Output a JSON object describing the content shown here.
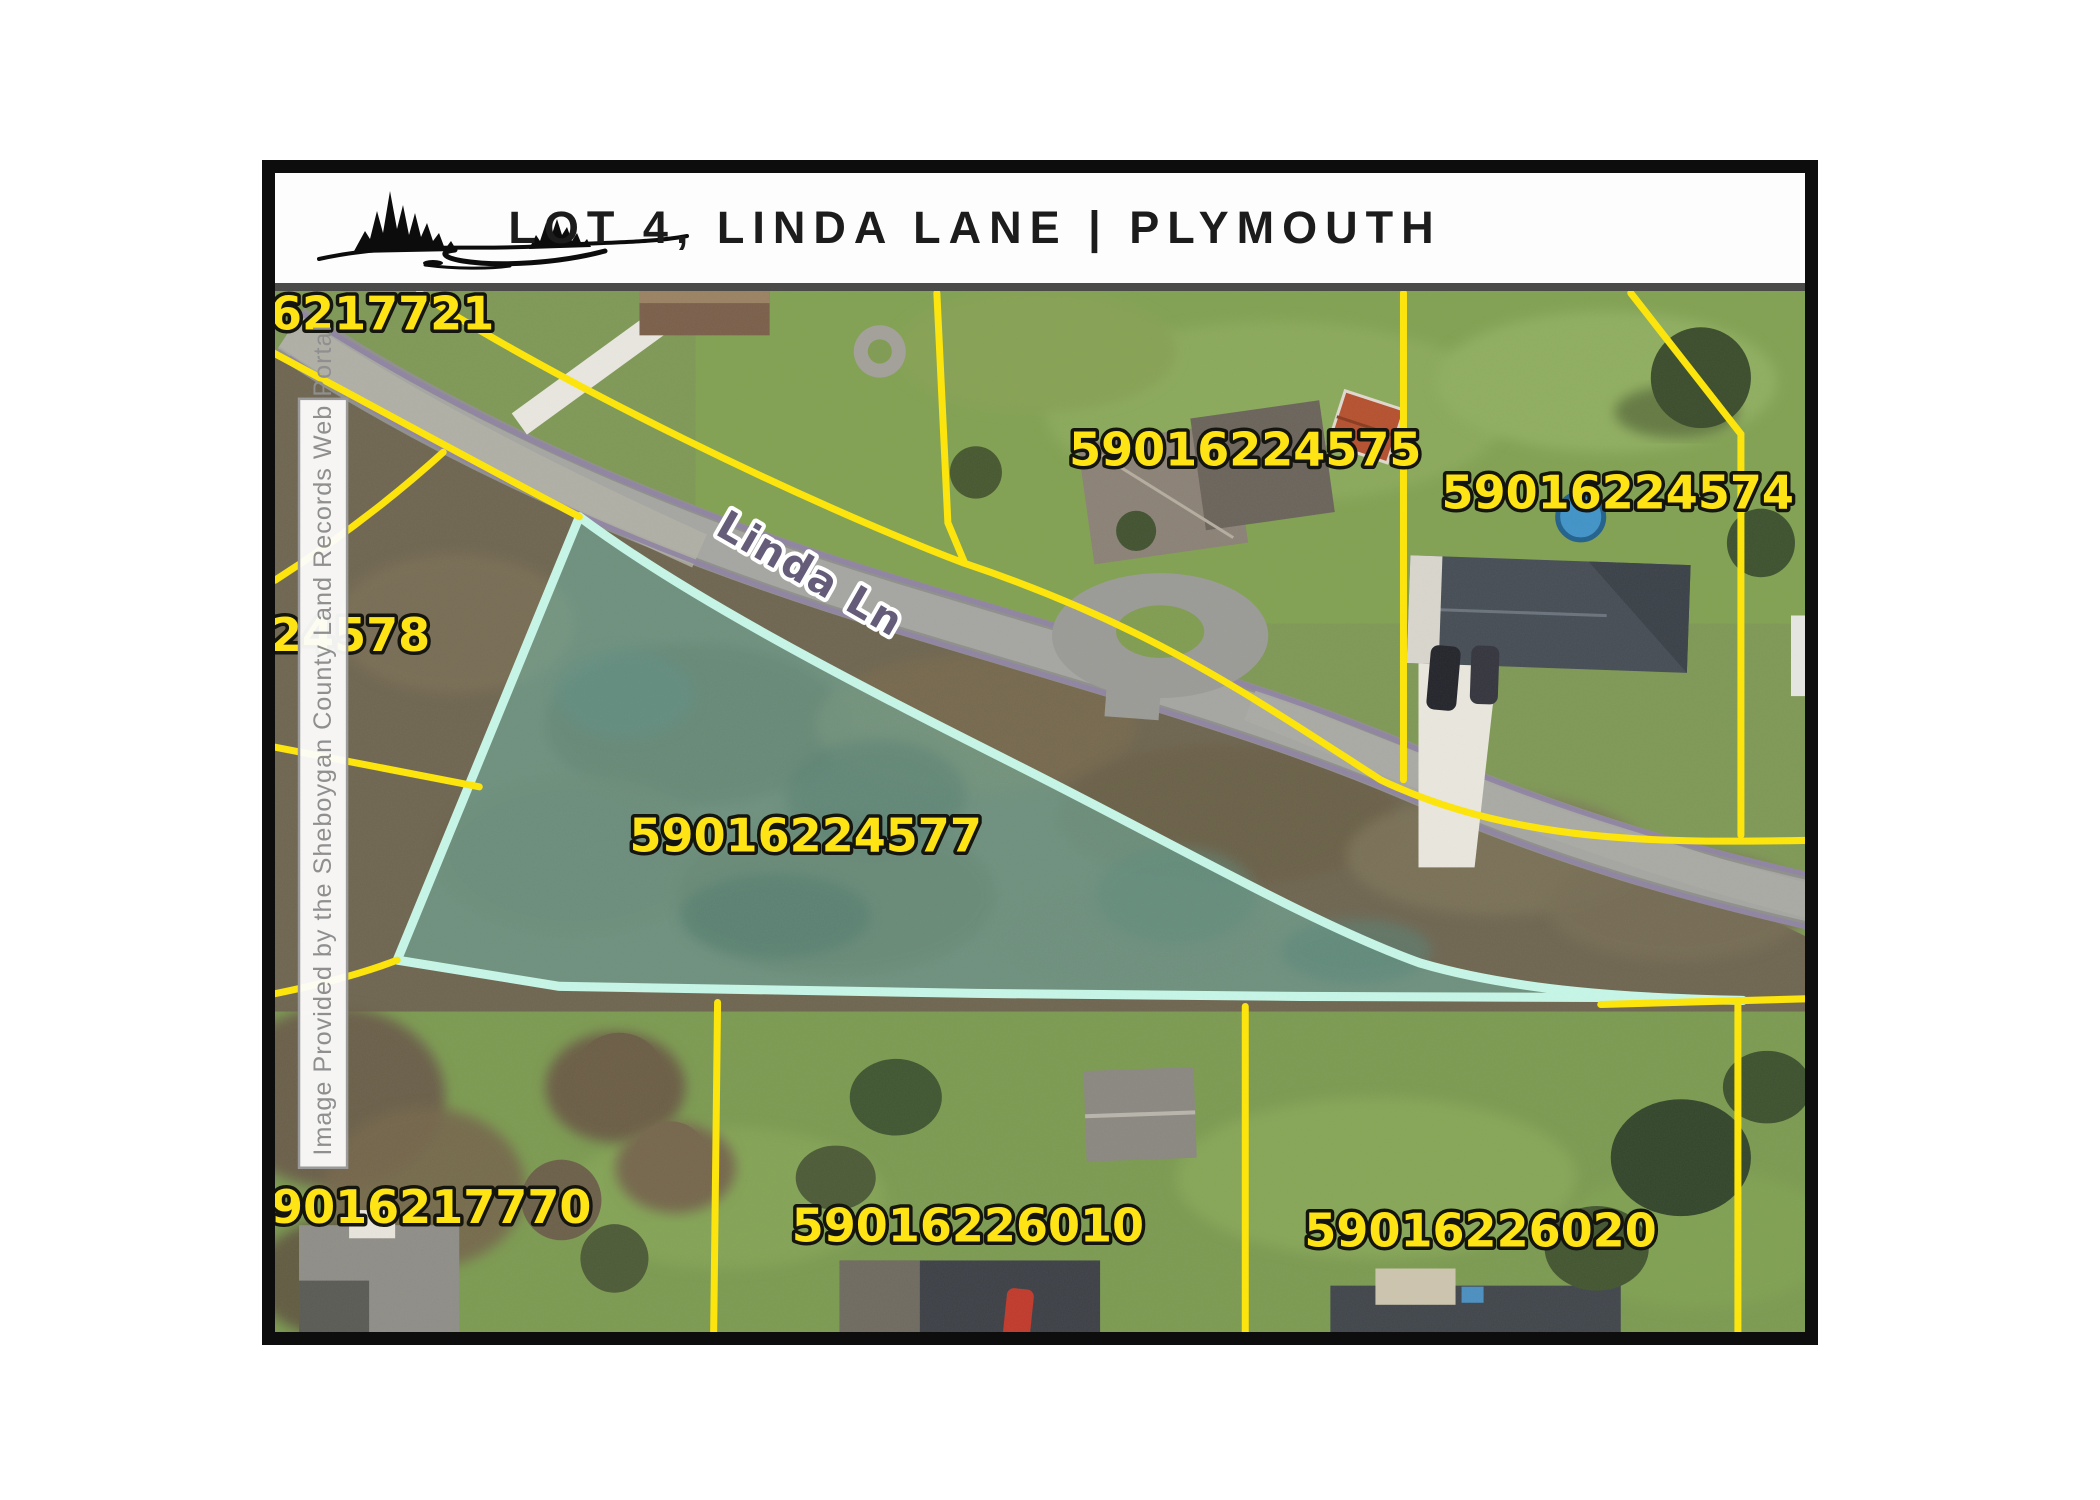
{
  "header": {
    "title": "LOT 4, LINDA LANE | PLYMOUTH"
  },
  "watermark": "Image Provided by the Sheboygan County Land Records Web Portal",
  "road": {
    "label": "Linda Ln"
  },
  "parcels": {
    "nw": "59016217721",
    "west": "59016224578",
    "north": "59016224575",
    "northeast": "59016224574",
    "highlighted": "59016224577",
    "southwest": "59016217770",
    "south": "59016226010",
    "southeast": "59016226020"
  },
  "highlight": {
    "parcel_id": "59016224577"
  },
  "colors": {
    "boundary_yellow": "#ffe606",
    "label_yellow": "#ffe415",
    "highlight_outline": "#c6f7e8",
    "highlight_fill": "rgba(110,205,190,0.38)",
    "road_edge_purple": "#8f84a3",
    "road_label_fill": "#645c78"
  }
}
